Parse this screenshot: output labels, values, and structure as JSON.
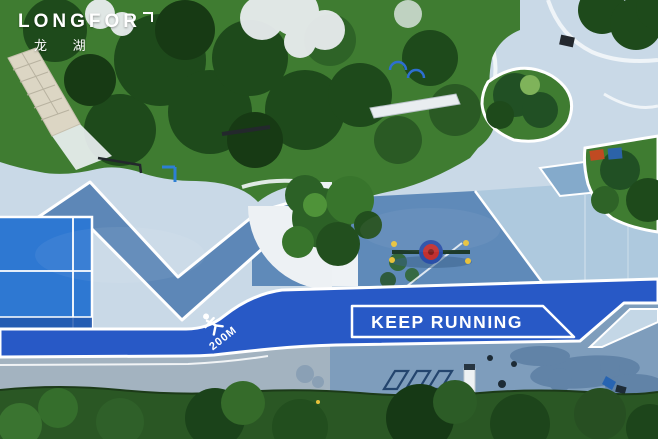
{
  "branding": {
    "logo_text": "LONGFOR",
    "logo_cn": "龙 湖"
  },
  "track": {
    "slogan": "KEEP RUNNING",
    "distance_marker": "200M"
  },
  "colors": {
    "plaza": "#c9d9e7",
    "band": "#5d87b7",
    "slate": "#5f8ab9",
    "lightzone": "#aec9de",
    "track": "#2859c6",
    "court": "#2e78d2",
    "pave_left": "#a3b3c0",
    "pave_right": "#7e9dbc",
    "grass_dark": "#2a5724",
    "grass_mid": "#3f7c31",
    "canopy_dark": "#1e4a1b",
    "blossom": "#e9edef"
  }
}
